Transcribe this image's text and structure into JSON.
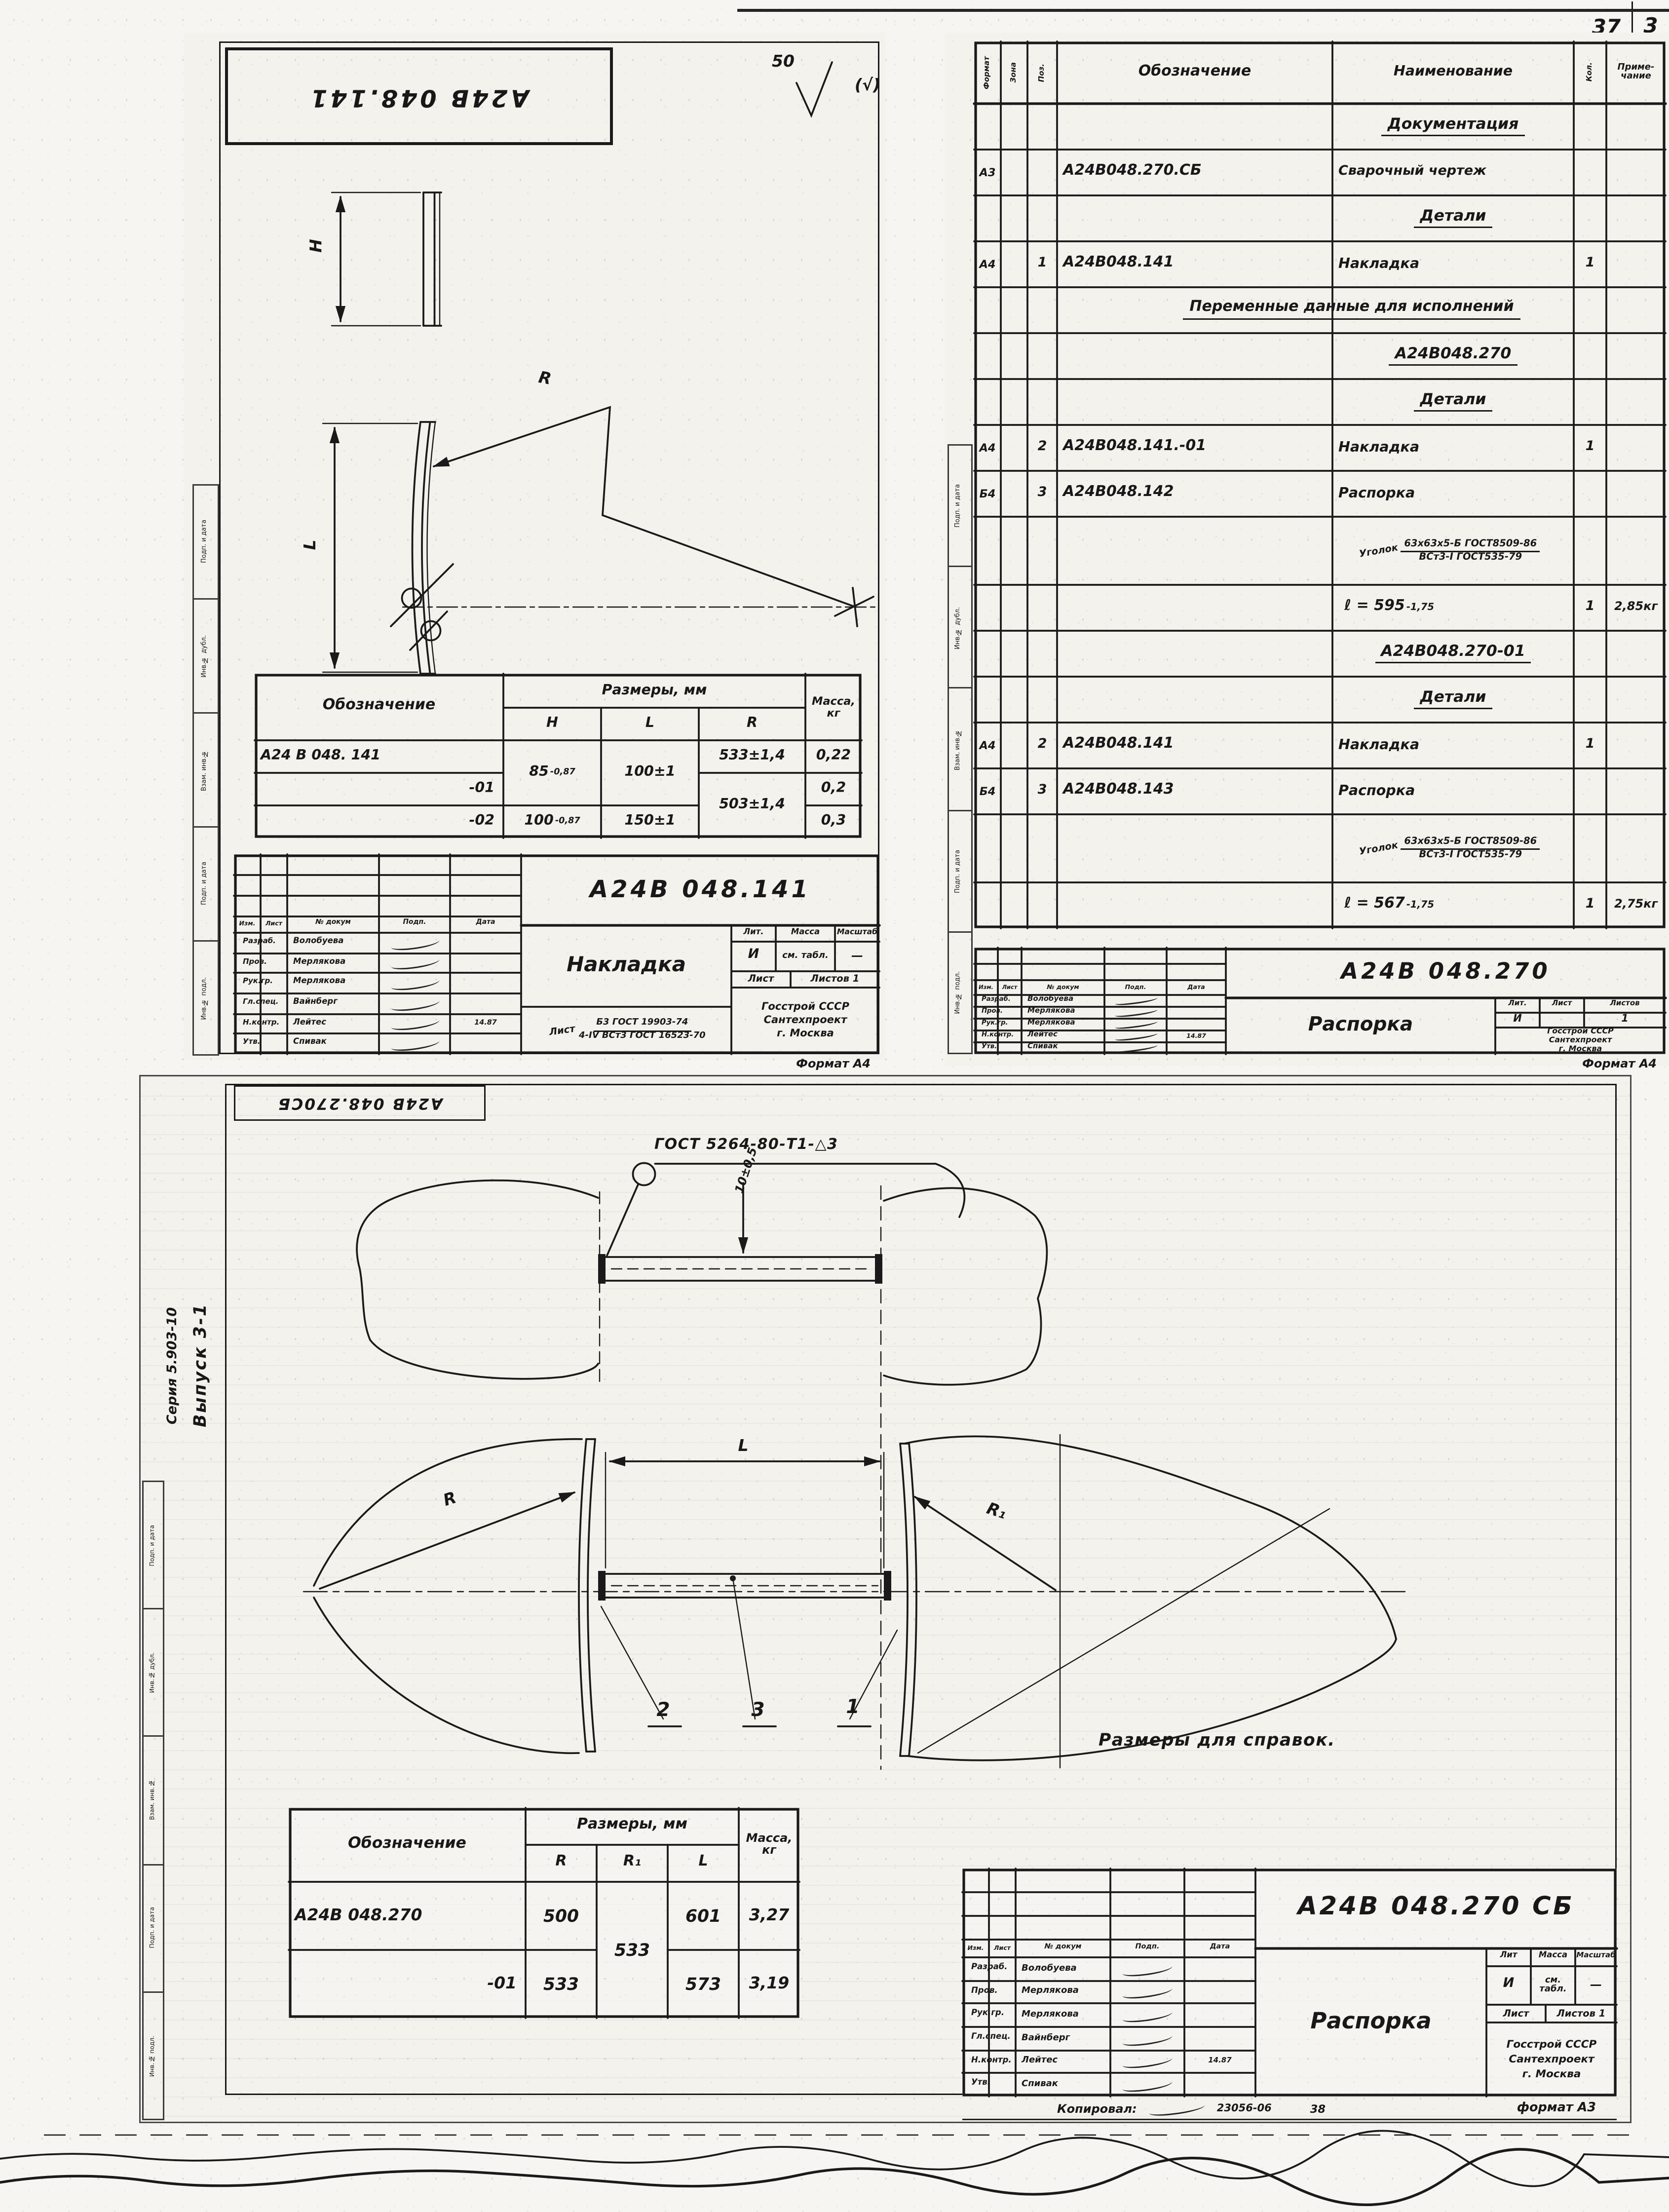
{
  "page": {
    "corner_left": "37",
    "corner_right": "3",
    "margin_labels": [
      "Подп. и дата",
      "Инв.№ дубл.",
      "Взам. инв.№",
      "Подп. и дата",
      "Инв.№ подл."
    ],
    "series": "Серия 5.903-10",
    "issue": "Выпуск 3-1"
  },
  "detail": {
    "stamp": "А24В 048.141",
    "rough_val": "50",
    "rough_note": "(√)",
    "dim_h": "H",
    "dim_l": "L",
    "dim_r": "R",
    "table": {
      "designation": "Обозначение",
      "sizes": "Размеры, мм",
      "mass1": "Масса,",
      "mass2": "кг",
      "h": "H",
      "l": "L",
      "r": "R",
      "d1": "А24 В 048. 141",
      "d2": "-01",
      "d3": "-02",
      "h12": "85",
      "h12_tol": "-0,87",
      "l12": "100±1",
      "r1": "533±1,4",
      "r23": "503±1,4",
      "h3": "100",
      "h3_tol": "-0,87",
      "l3": "150±1",
      "m1": "0,22",
      "m2": "0,2",
      "m3": "0,3"
    },
    "tb": {
      "doc": "А24В 048.141",
      "name": "Накладка",
      "lit_h": "Лит.",
      "mass_h": "Масса",
      "scale_h": "Масштаб",
      "lit": "И",
      "mass": "см. табл.",
      "scale": "—",
      "sheet": "Лист",
      "sheets": "Листов 1",
      "mat_pre": "Лист",
      "mat_top": "Б3 ГОСТ 19903-74",
      "mat_bot": "4-IV ВСт3 ГОСТ 16523-70",
      "org1": "Госстрой СССР",
      "org2": "Сантехпроект",
      "org3": "г. Москва",
      "format": "Формат А4",
      "c1": "Изм.",
      "c2": "Лист",
      "c3": "№ докум",
      "c4": "Подп.",
      "c5": "Дата",
      "r1_role": "Разраб.",
      "r1_name": "Волобуева",
      "r2_role": "Пров.",
      "r2_name": "Мерлякова",
      "r3_role": "Рук.гр.",
      "r3_name": "Мерлякова",
      "r4_role": "Гл.спец.",
      "r4_name": "Вайнберг",
      "r5_role": "Н.контр.",
      "r5_name": "Лейтес",
      "r5_date": "14.87",
      "r6_role": "Утв.",
      "r6_name": "Спивак"
    }
  },
  "spec": {
    "h_fmt": "Формат",
    "h_zone": "Зона",
    "h_pos": "Поз.",
    "h_des": "Обозначение",
    "h_name": "Наименование",
    "h_qty": "Кол.",
    "h_note1": "Приме-",
    "h_note2": "чание",
    "r0": "Документация",
    "r1_fmt": "А3",
    "r1_des": "А24В048.270.СБ",
    "r1_name": "Сварочный чертеж",
    "r2": "Детали",
    "r3_fmt": "А4",
    "r3_pos": "1",
    "r3_des": "А24В048.141",
    "r3_name": "Накладка",
    "r3_qty": "1",
    "r4": "Переменные данные для исполнений",
    "r5": "А24В048.270",
    "r6": "Детали",
    "r7_fmt": "А4",
    "r7_pos": "2",
    "r7_des": "А24В048.141.-01",
    "r7_name": "Накладка",
    "r7_qty": "1",
    "r8_fmt": "Б4",
    "r8_pos": "3",
    "r8_des": "А24В048.142",
    "r8_name": "Распорка",
    "r9_pre": "Уголок",
    "r9_top": "63х63х5-Б ГОСТ8509-86",
    "r9_bot": "ВСт3-I ГОСТ535-79",
    "r10_len": "ℓ = 595",
    "r10_tol": "-1,75",
    "r10_qty": "1",
    "r10_note": "2,85кг",
    "r11": "А24В048.270-01",
    "r12": "Детали",
    "r13_fmt": "А4",
    "r13_pos": "2",
    "r13_des": "А24В048.141",
    "r13_name": "Накладка",
    "r13_qty": "1",
    "r14_fmt": "Б4",
    "r14_pos": "3",
    "r14_des": "А24В048.143",
    "r14_name": "Распорка",
    "r15_pre": "Уголок",
    "r15_top": "63х63х5-Б ГОСТ8509-86",
    "r15_bot": "ВСт3-I ГОСТ535-79",
    "r16_len": "ℓ = 567",
    "r16_tol": "-1,75",
    "r16_qty": "1",
    "r16_note": "2,75кг",
    "tb": {
      "doc": "А24В 048.270",
      "name": "Распорка",
      "lit_h": "Лит.",
      "sheet_h": "Лист",
      "sheets_h": "Листов",
      "lit": "И",
      "sheets": "1",
      "org1": "Госстрой СССР",
      "org2": "Сантехпроект",
      "org3": "г. Москва",
      "format": "Формат А4",
      "c1": "Изм.",
      "c2": "Лист",
      "c3": "№ докум",
      "c4": "Подп.",
      "c5": "Дата",
      "r1_role": "Разраб.",
      "r1_name": "Волобуева",
      "r2_role": "Пров.",
      "r2_name": "Мерлякова",
      "r3_role": "Рук.гр.",
      "r3_name": "Мерлякова",
      "r4_role": "Н.контр.",
      "r4_name": "Лейтес",
      "r4_date": "14.87",
      "r5_role": "Утв.",
      "r5_name": "Спивак"
    }
  },
  "asm": {
    "stamp": "А24В 048.270СБ",
    "weld": "ГОСТ 5264-80-Т1-△3",
    "dim10": "10±0,5",
    "l": "L",
    "r": "R",
    "r1": "R₁",
    "c2": "2",
    "c3": "3",
    "c1": "1",
    "note": "Размеры для справок.",
    "table": {
      "designation": "Обозначение",
      "sizes": "Размеры, мм",
      "mass1": "Масса,",
      "mass2": "кг",
      "r": "R",
      "r1": "R₁",
      "l": "L",
      "d1": "А24В 048.270",
      "d2": "-01",
      "v_r1": "500",
      "v_r2": "533",
      "v_r1shared": "533",
      "v_l1": "601",
      "v_l2": "573",
      "v_m1": "3,27",
      "v_m2": "3,19"
    },
    "tb": {
      "doc": "А24В 048.270 СБ",
      "name": "Распорка",
      "lit_h": "Лит",
      "mass_h": "Масса",
      "scale_h": "Масштаб",
      "lit": "И",
      "mass": "см. табл.",
      "scale": "—",
      "sheet": "Лист",
      "sheets": "Листов 1",
      "org1": "Госстрой СССР",
      "org2": "Сантехпроект",
      "org3": "г. Москва",
      "c1": "Изм.",
      "c2": "Лист",
      "c3": "№ докум",
      "c4": "Подп.",
      "c5": "Дата",
      "r1_role": "Разраб.",
      "r1_name": "Волобуева",
      "r2_role": "Пров.",
      "r2_name": "Мерлякова",
      "r3_role": "Рук.гр.",
      "r3_name": "Мерлякова",
      "r4_role": "Гл.спец.",
      "r4_name": "Вайнберг",
      "r5_role": "Н.контр.",
      "r5_name": "Лейтес",
      "r5_date": "14.87",
      "r6_role": "Утв.",
      "r6_name": "Спивак"
    },
    "copy": {
      "label": "Копировал:",
      "code": "23056-06",
      "num": "38",
      "fmt": "формат А3"
    }
  }
}
